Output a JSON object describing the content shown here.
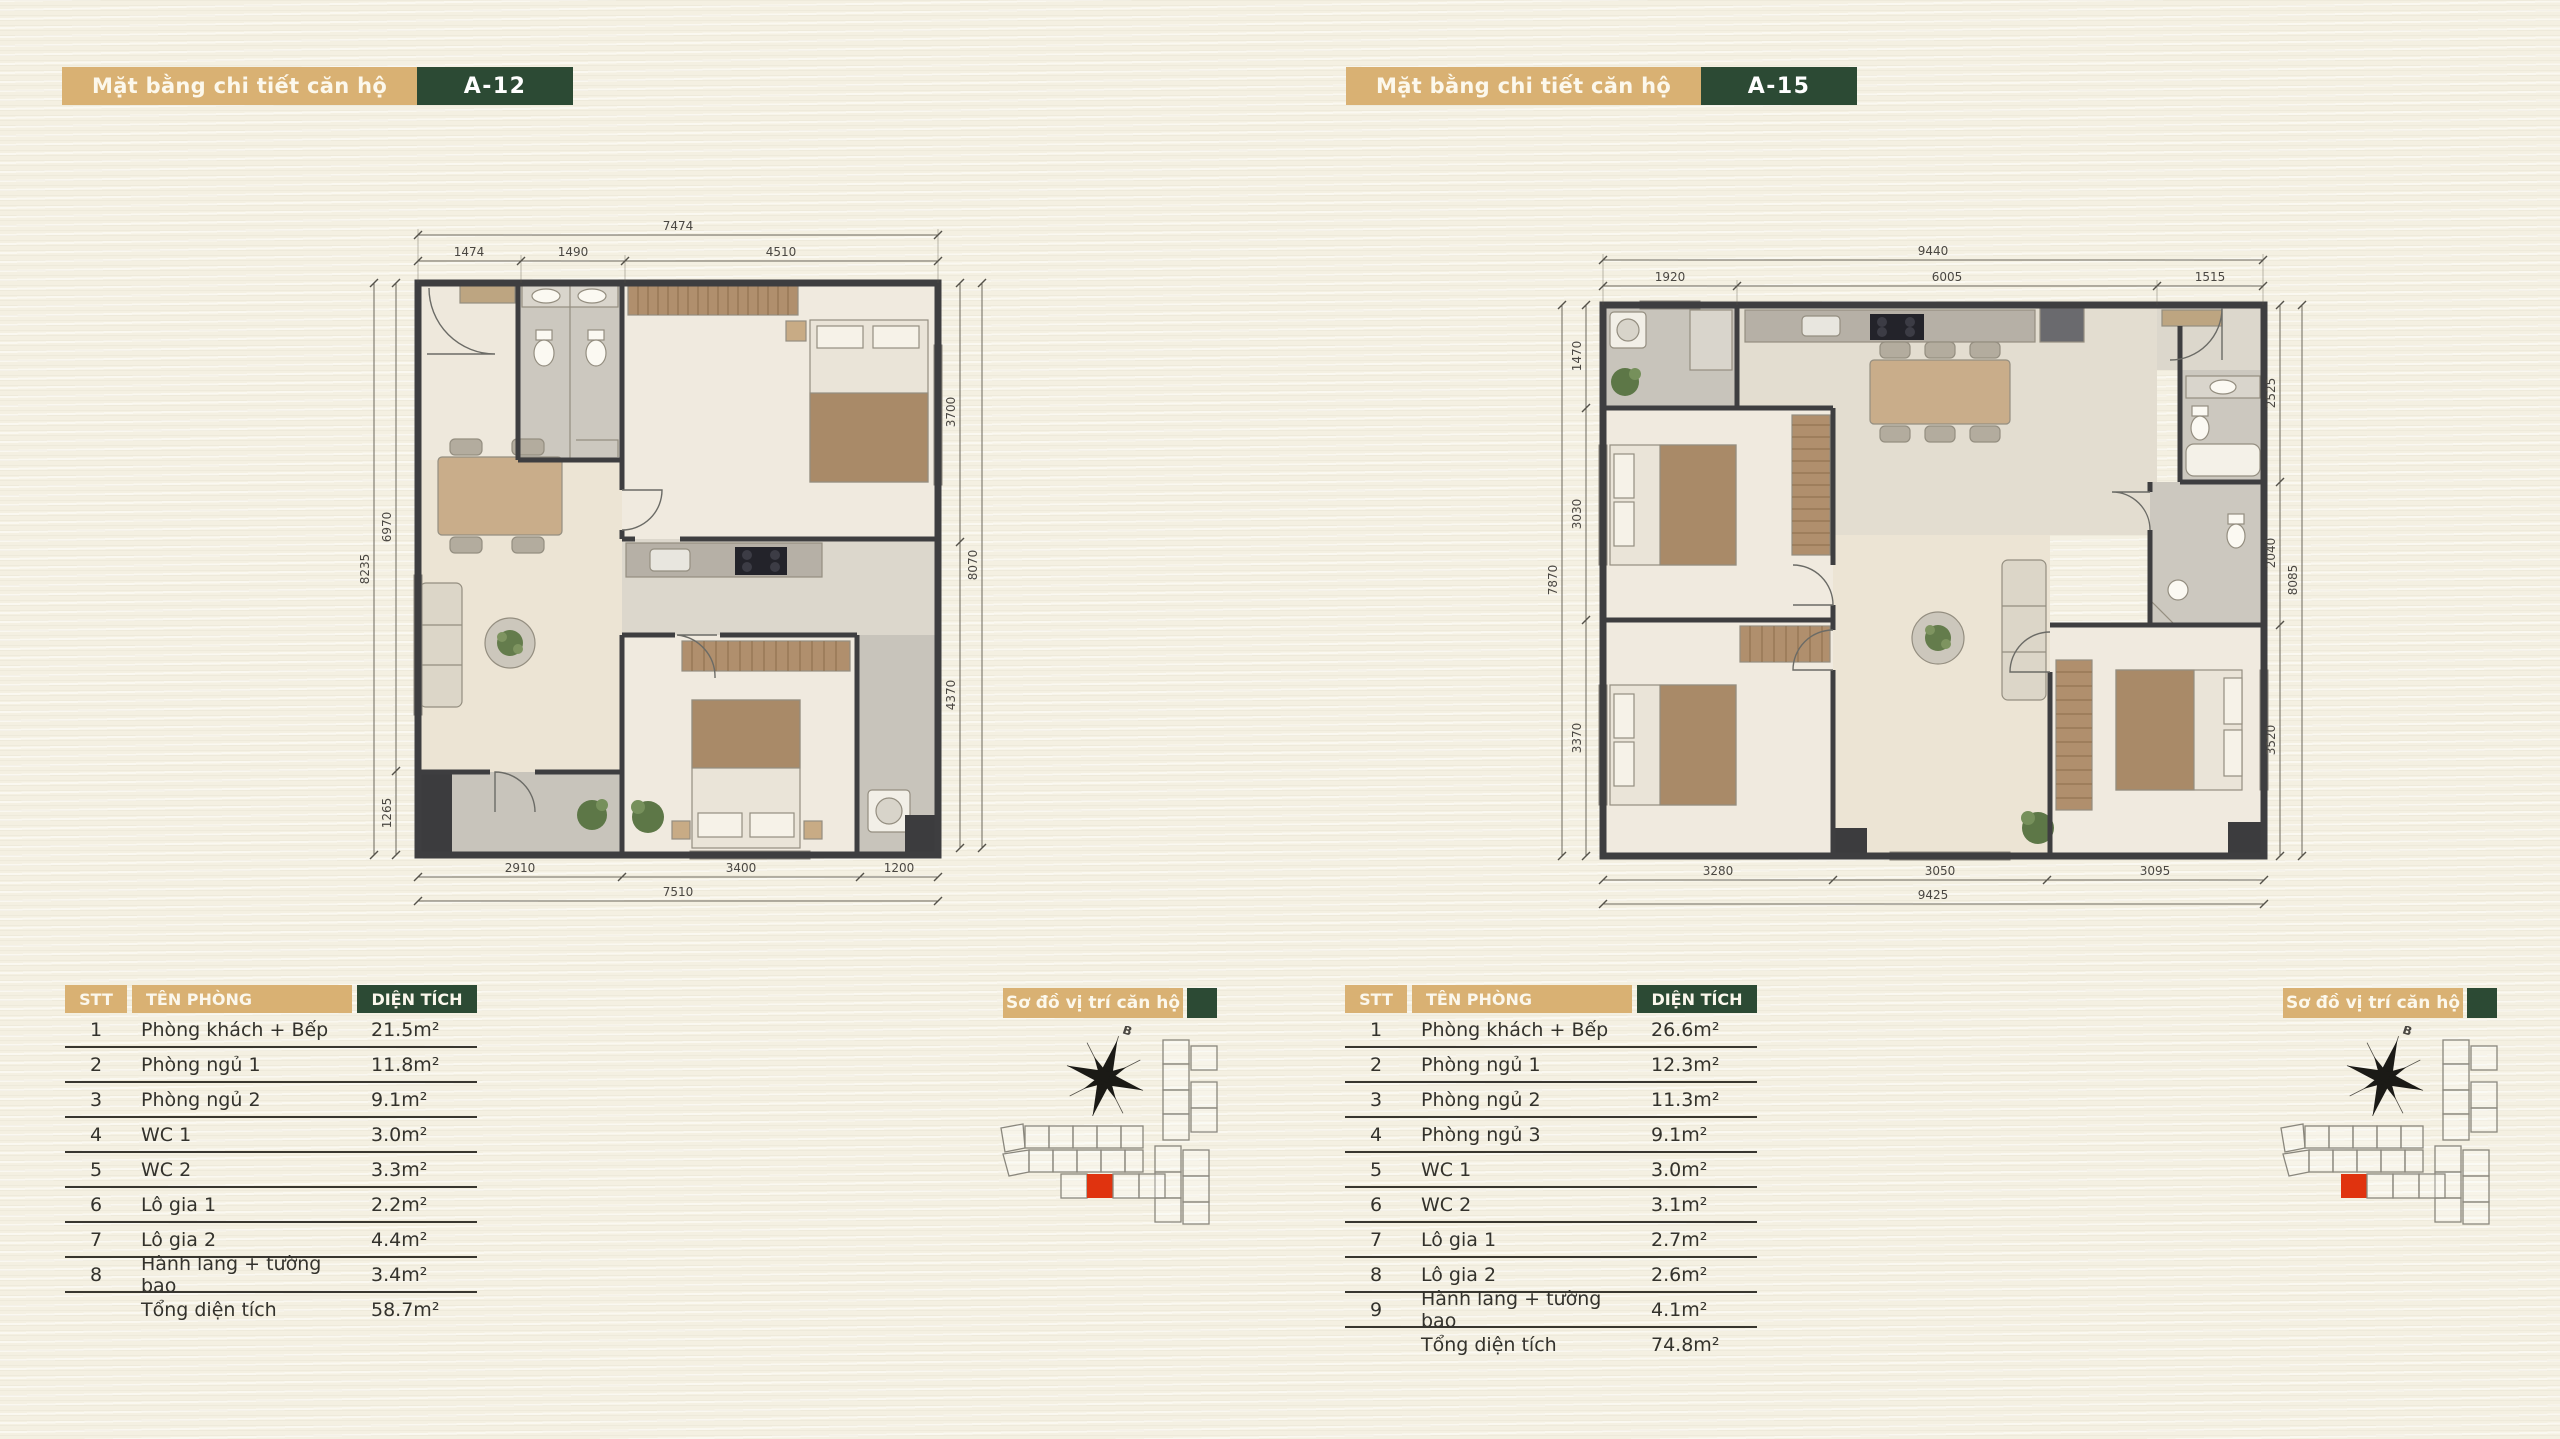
{
  "background": "#f4f0e2",
  "colors": {
    "tan_accent": "#d9b173",
    "dark_green_accent": "#2c4a34",
    "table_text": "#33322c",
    "unit_highlight_red": "#e0330f",
    "wall_gray": "#3e3e40"
  },
  "panels": [
    {
      "header": {
        "title": "Mặt bằng chi tiết căn hộ",
        "unit": "A-12"
      },
      "plan": {
        "dims": {
          "top_overall": "7474",
          "top_segments": [
            "1474",
            "1490",
            "4510"
          ],
          "bottom_overall": "7510",
          "bottom_segments": [
            "2910",
            "3400",
            "1200"
          ],
          "left_overall": "8235",
          "left_segments": [
            "6970",
            "1265"
          ],
          "right_overall": "8070",
          "right_segments": [
            "3700",
            "4370"
          ]
        }
      },
      "table": {
        "headers": [
          "STT",
          "TÊN PHÒNG",
          "DIỆN TÍCH"
        ],
        "rows": [
          {
            "num": "1",
            "name": "Phòng khách + Bếp",
            "area": "21.5m²"
          },
          {
            "num": "2",
            "name": "Phòng ngủ 1",
            "area": "11.8m²"
          },
          {
            "num": "3",
            "name": "Phòng ngủ 2",
            "area": "9.1m²"
          },
          {
            "num": "4",
            "name": "WC 1",
            "area": "3.0m²"
          },
          {
            "num": "5",
            "name": "WC 2",
            "area": "3.3m²"
          },
          {
            "num": "6",
            "name": "Lô gia 1",
            "area": "2.2m²"
          },
          {
            "num": "7",
            "name": "Lô gia 2",
            "area": "4.4m²"
          },
          {
            "num": "8",
            "name": "Hành lang + tường bao",
            "area": "3.4m²"
          }
        ],
        "total_label": "Tổng diện tích",
        "total_value": "58.7m²"
      },
      "location": {
        "label": "Sơ đồ vị trí căn hộ",
        "compass_label": "B"
      }
    },
    {
      "header": {
        "title": "Mặt bằng chi tiết căn hộ",
        "unit": "A-15"
      },
      "plan": {
        "dims": {
          "top_overall": "9440",
          "top_segments": [
            "1920",
            "6005",
            "1515"
          ],
          "bottom_overall": "9425",
          "bottom_segments": [
            "3280",
            "3050",
            "3095"
          ],
          "left_overall": "7870",
          "left_segments": [
            "1470",
            "3030",
            "3370"
          ],
          "right_overall": "8085",
          "right_segments": [
            "2525",
            "2040",
            "3520"
          ]
        }
      },
      "table": {
        "headers": [
          "STT",
          "TÊN PHÒNG",
          "DIỆN TÍCH"
        ],
        "rows": [
          {
            "num": "1",
            "name": "Phòng khách + Bếp",
            "area": "26.6m²"
          },
          {
            "num": "2",
            "name": "Phòng ngủ 1",
            "area": "12.3m²"
          },
          {
            "num": "3",
            "name": "Phòng ngủ 2",
            "area": "11.3m²"
          },
          {
            "num": "4",
            "name": "Phòng ngủ 3",
            "area": "9.1m²"
          },
          {
            "num": "5",
            "name": "WC 1",
            "area": "3.0m²"
          },
          {
            "num": "6",
            "name": "WC 2",
            "area": "3.1m²"
          },
          {
            "num": "7",
            "name": "Lô gia 1",
            "area": "2.7m²"
          },
          {
            "num": "8",
            "name": "Lô gia 2",
            "area": "2.6m²"
          },
          {
            "num": "9",
            "name": "Hành lang + tường bao",
            "area": "4.1m²"
          }
        ],
        "total_label": "Tổng diện tích",
        "total_value": "74.8m²"
      },
      "location": {
        "label": "Sơ đồ vị trí căn hộ",
        "compass_label": "B"
      }
    }
  ]
}
